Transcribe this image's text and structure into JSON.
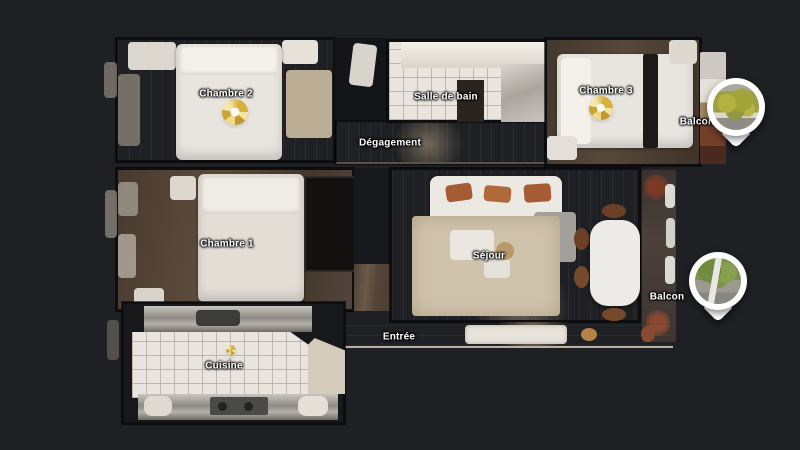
{
  "scene": {
    "type": "3d-dollhouse-floorplan-top-view",
    "background_color": "#1e2023"
  },
  "floorplan": {
    "rooms": [
      {
        "id": "chambre-2",
        "label": "Chambre 2"
      },
      {
        "id": "salle-de-bain",
        "label": "Salle de bain"
      },
      {
        "id": "chambre-3",
        "label": "Chambre 3"
      },
      {
        "id": "balcon-haut",
        "label": "Balcon"
      },
      {
        "id": "degagement",
        "label": "Dégagement"
      },
      {
        "id": "chambre-1",
        "label": "Chambre 1"
      },
      {
        "id": "sejour",
        "label": "Séjour"
      },
      {
        "id": "balcon-droit",
        "label": "Balcon"
      },
      {
        "id": "entree",
        "label": "Entrée"
      },
      {
        "id": "cuisine",
        "label": "Cuisine"
      }
    ],
    "markers": [
      {
        "id": "sweep-marker-chambre-2",
        "icon": "gold-360-sweep-icon"
      },
      {
        "id": "sweep-marker-chambre-3",
        "icon": "gold-360-sweep-icon"
      },
      {
        "id": "sweep-marker-cuisine",
        "icon": "gold-360-sweep-icon"
      },
      {
        "id": "balcony-photo-pin-top",
        "icon": "photo-pin-icon"
      },
      {
        "id": "balcony-photo-pin-right",
        "icon": "photo-pin-icon"
      }
    ],
    "colors": {
      "wood_floor_dark": "#4a3c31",
      "wood_floor_gray": "#7b736c",
      "tile_floor": "#e9e5de",
      "label_text": "#ffffff",
      "sweep_gold": "#d7b13c",
      "pin_white": "#ffffff"
    }
  }
}
